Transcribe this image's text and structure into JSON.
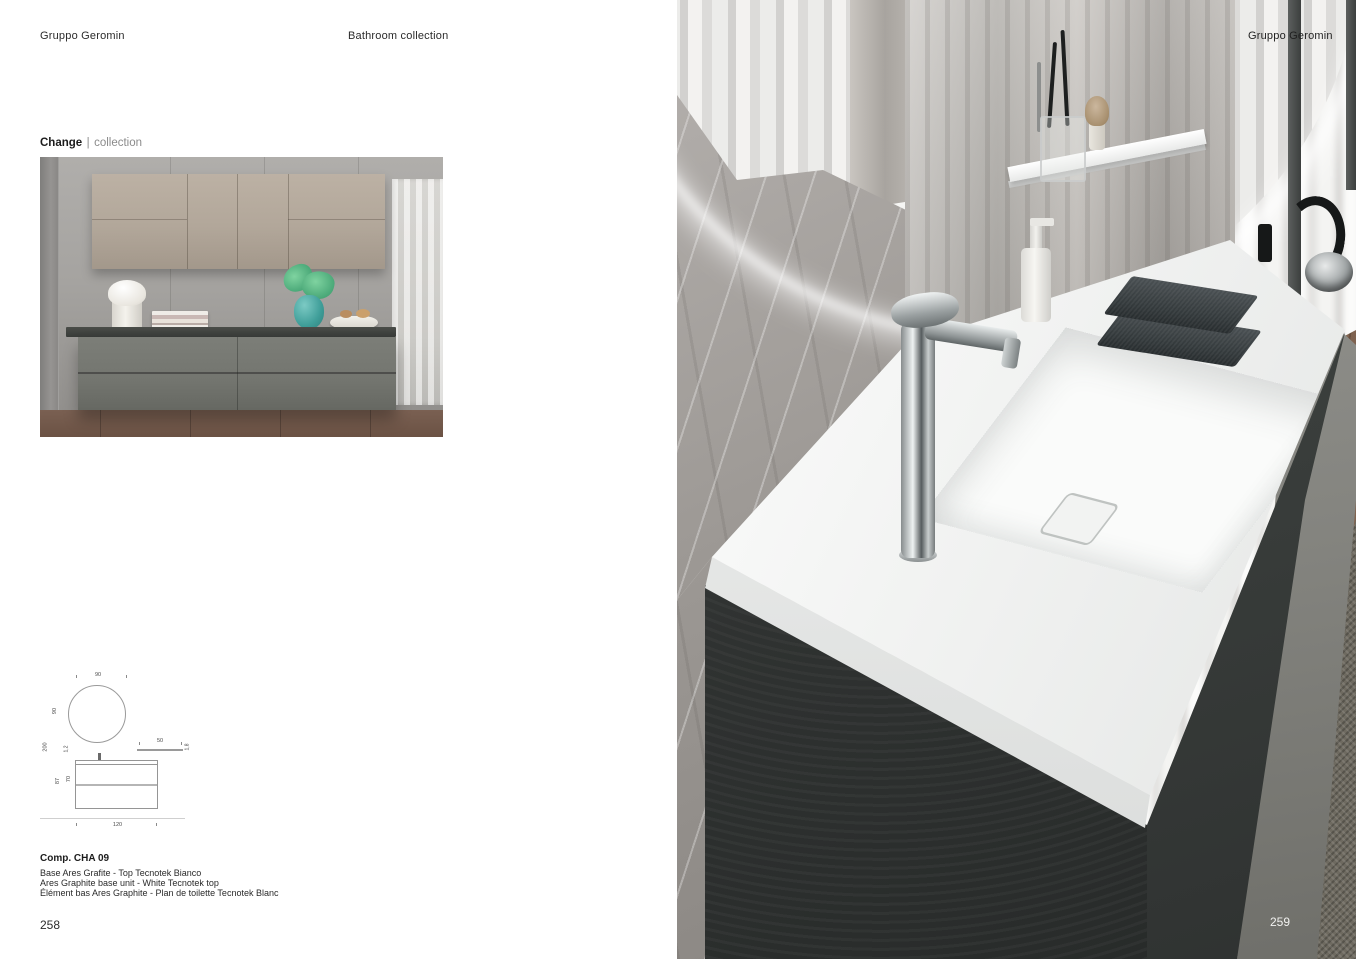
{
  "document": {
    "left_page": {
      "header_brand": "Gruppo Geromin",
      "header_title": "Bathroom collection",
      "collection_name": "Change",
      "collection_separator": "|",
      "collection_suffix": "collection",
      "drawing": {
        "dim_mirror_width": "90",
        "dim_mirror_height": "90",
        "dim_total_height": "200",
        "dim_top_thickness": "1,2",
        "dim_shelf_depth": "50",
        "dim_shelf_thickness": "1,8",
        "dim_floor_to_top": "87",
        "dim_base_height": "70",
        "dim_base_width": "120"
      },
      "caption_code": "Comp. CHA 09",
      "caption_it": "Base Ares Grafite - Top Tecnotek Bianco",
      "caption_en": "Ares Graphite base unit - White Tecnotek top",
      "caption_fr": "Élément bas Ares Graphite - Plan de toilette Tecnotek Blanc",
      "page_number": "258"
    },
    "right_page": {
      "header_brand": "Gruppo Geromin",
      "page_number": "259"
    },
    "palette": {
      "graphite_unit": "#343735",
      "taupe_wall_cabinet": "#b2a79a",
      "white_tecnotek_top": "#f5f5f3",
      "teal_vase": "#3f9e99",
      "wood_floor": "#8a6c58",
      "marble_grey": "#9c9894"
    }
  }
}
